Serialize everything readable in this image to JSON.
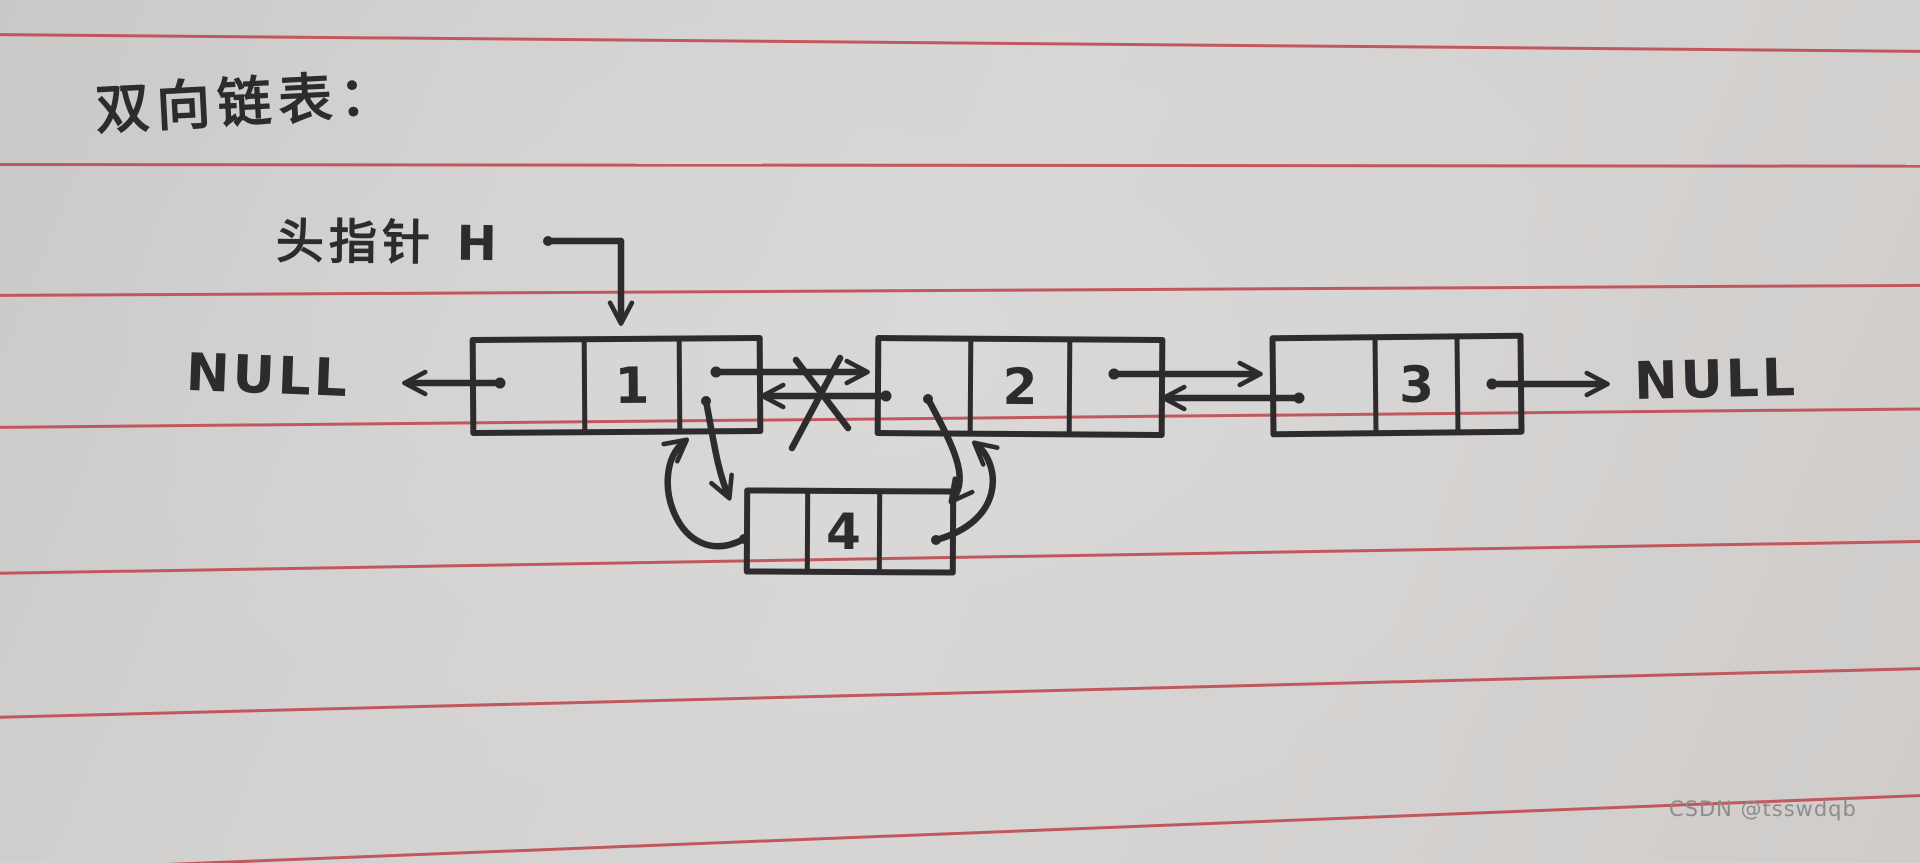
{
  "title": "双向链表：",
  "head_pointer": {
    "label": "头指针 H"
  },
  "left_null": "NULL",
  "right_null": "NULL",
  "nodes": [
    {
      "name": "node-1",
      "value": "1"
    },
    {
      "name": "node-2",
      "value": "2"
    },
    {
      "name": "node-3",
      "value": "3"
    },
    {
      "name": "node-4",
      "value": "4"
    }
  ],
  "watermark": "CSDN @tsswdqb",
  "colors": {
    "paper": "#d5d3d1",
    "rule_line": "#bf4d56",
    "ink": "#2d2b2d",
    "watermark_text": "#8e8c8a"
  }
}
